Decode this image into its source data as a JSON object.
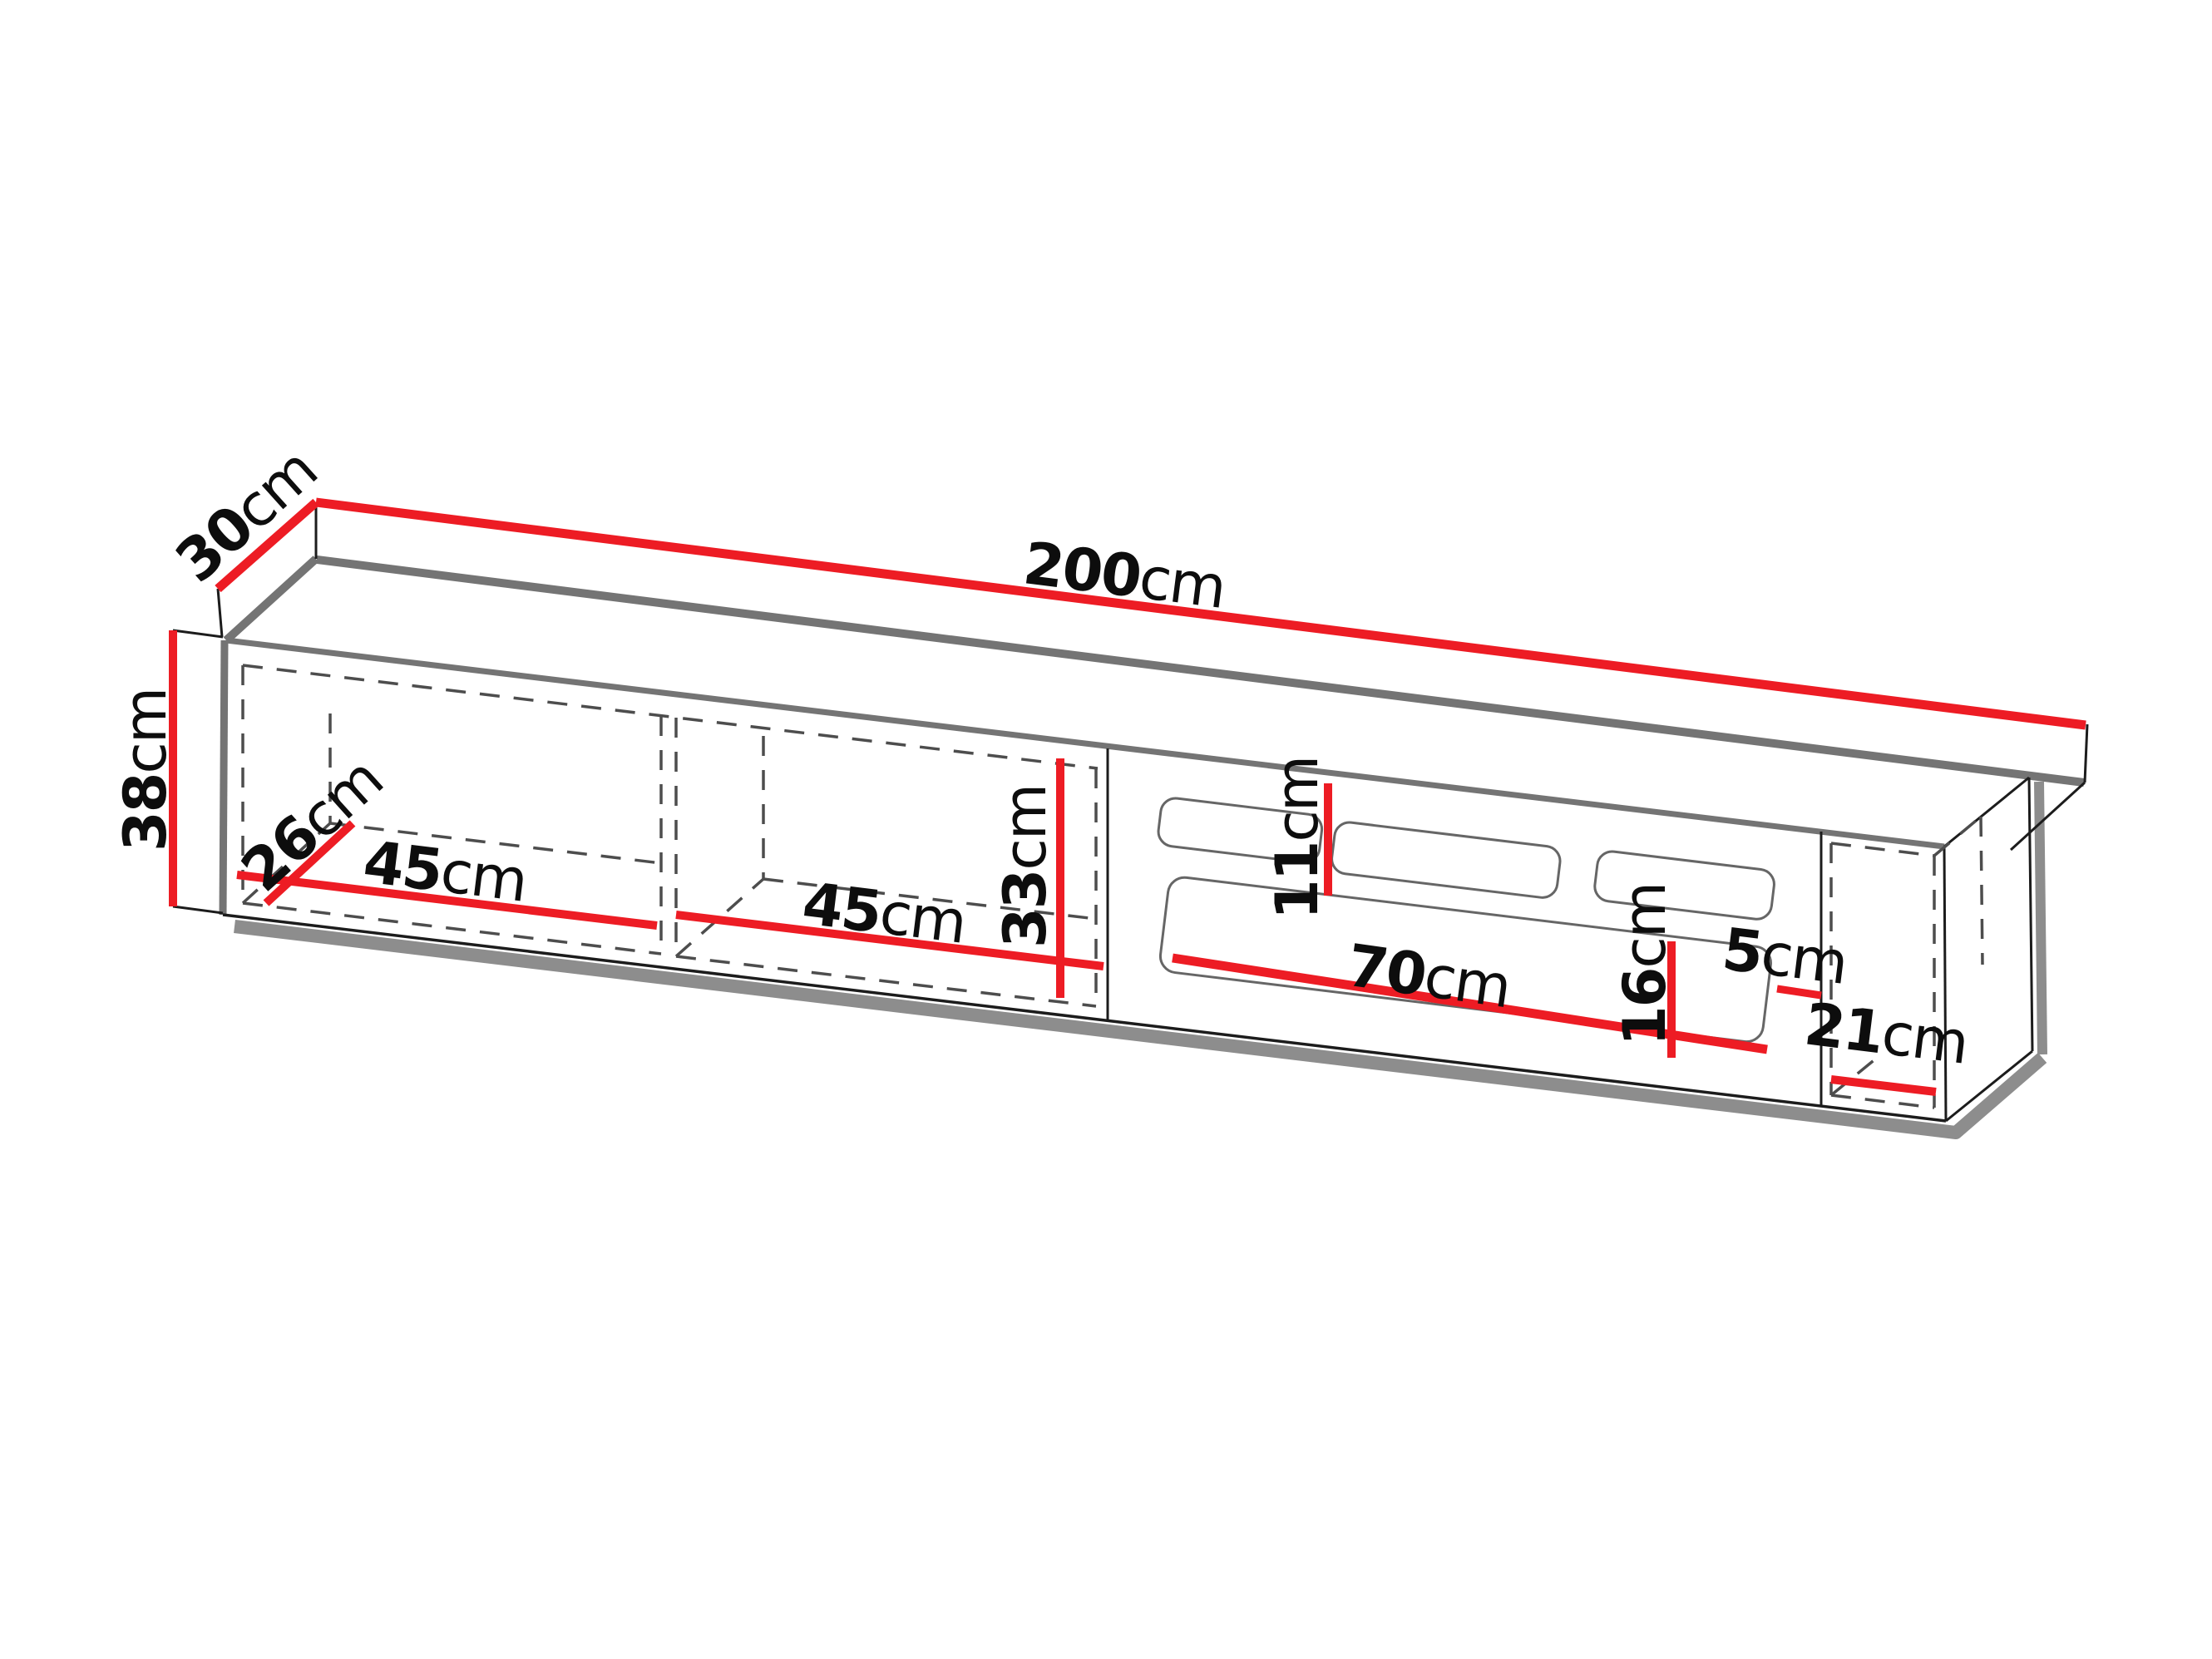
{
  "diagram": {
    "title": "",
    "dimensions": {
      "d200": {
        "value": "200",
        "unit": "cm"
      },
      "d30": {
        "value": "30",
        "unit": "cm"
      },
      "d38": {
        "value": "38",
        "unit": "cm"
      },
      "d26": {
        "value": "26",
        "unit": "cm"
      },
      "d45a": {
        "value": "45",
        "unit": "cm"
      },
      "d45b": {
        "value": "45",
        "unit": "cm"
      },
      "d33": {
        "value": "33",
        "unit": "cm"
      },
      "d11": {
        "value": "11",
        "unit": "cm"
      },
      "d70": {
        "value": "70",
        "unit": "cm"
      },
      "d16": {
        "value": "16",
        "unit": "cm"
      },
      "d5": {
        "value": "5",
        "unit": "cm"
      },
      "d21": {
        "value": "21",
        "unit": "cm"
      }
    },
    "colors": {
      "dimension_red": "#ed1c24",
      "outline_black": "#1c1c1c",
      "edge_gray": "#747474",
      "shadow_gray": "#8d8d8d",
      "dash_gray": "#4d4d4d",
      "text_black": "#0d0d0d",
      "background": "#ffffff"
    }
  }
}
